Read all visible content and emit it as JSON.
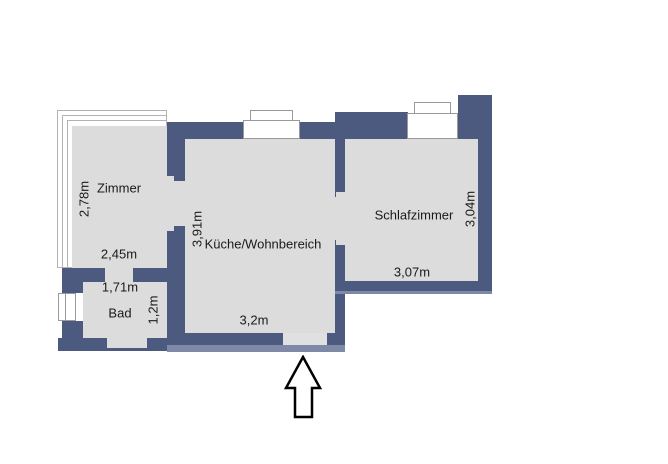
{
  "floorplan": {
    "rooms": [
      {
        "id": "zimmer",
        "name": "Zimmer",
        "width_label": "2,45m",
        "depth_label": "2,78m"
      },
      {
        "id": "kueche",
        "name": "Küche/Wohnbereich",
        "width_label": "3,2m",
        "depth_label": "3,91m"
      },
      {
        "id": "schlafzimmer",
        "name": "Schlafzimmer",
        "width_label": "3,07m",
        "depth_label": "3,04m"
      },
      {
        "id": "bad",
        "name": "Bad",
        "width_label": "1,71m",
        "depth_label": "1,2m"
      }
    ],
    "icons": {
      "entrance_arrow": "arrow-up"
    },
    "colors": {
      "background": "#ffffff",
      "wall": "#4b5a7e",
      "wall_shadow": "#7e89a8",
      "floor": "#dcdcdc",
      "door_gap": "#e0e0e0",
      "window_border": "#999999",
      "outline": "#b3b3b3",
      "text": "#1a1a1a",
      "arrow_outline": "#000000"
    }
  }
}
